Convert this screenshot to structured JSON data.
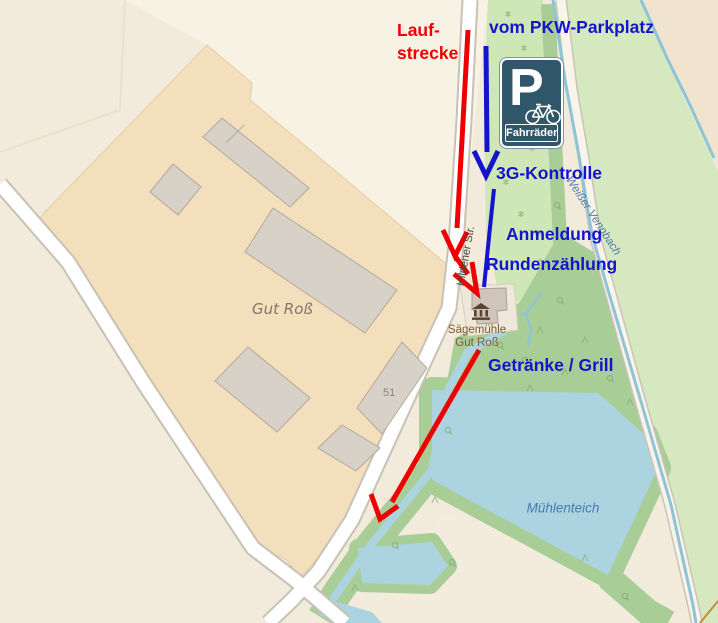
{
  "annotations": {
    "laufstrecke_line1": "Lauf-",
    "laufstrecke_line2": "strecke",
    "vom_parkplatz": "vom PKW-Parkplatz",
    "kontrolle": "3G-Kontrolle",
    "anmeldung": "Anmeldung",
    "rundenzaehlung": "Rundenzählung",
    "getraenke": "Getränke / Grill"
  },
  "sign": {
    "p_glyph": "P",
    "label": "Fahrräder"
  },
  "map_labels": {
    "farm": "Gut Roß",
    "house_number": "51",
    "street": "Hildener Str.",
    "stream": "Weißer Vennbach",
    "pond": "Mühlenteich",
    "mill_line1": "Sägemühle",
    "mill_line2": "Gut Roß"
  },
  "colors": {
    "ann_red": "#ee0000",
    "ann_blue": "#1414cc",
    "sign_bg": "#2f5669",
    "water": "#abd4e0",
    "stream_line": "#8fc3d6",
    "forest_green": "#a9cd97",
    "grass_green": "#cfe6b6",
    "meadow_green": "#d6e8bf",
    "farmyard_tan": "#f4dfbc",
    "farmland_beige": "#f2ebdb",
    "road_fill": "#ffffff",
    "road_casing": "#c7c1b6"
  }
}
